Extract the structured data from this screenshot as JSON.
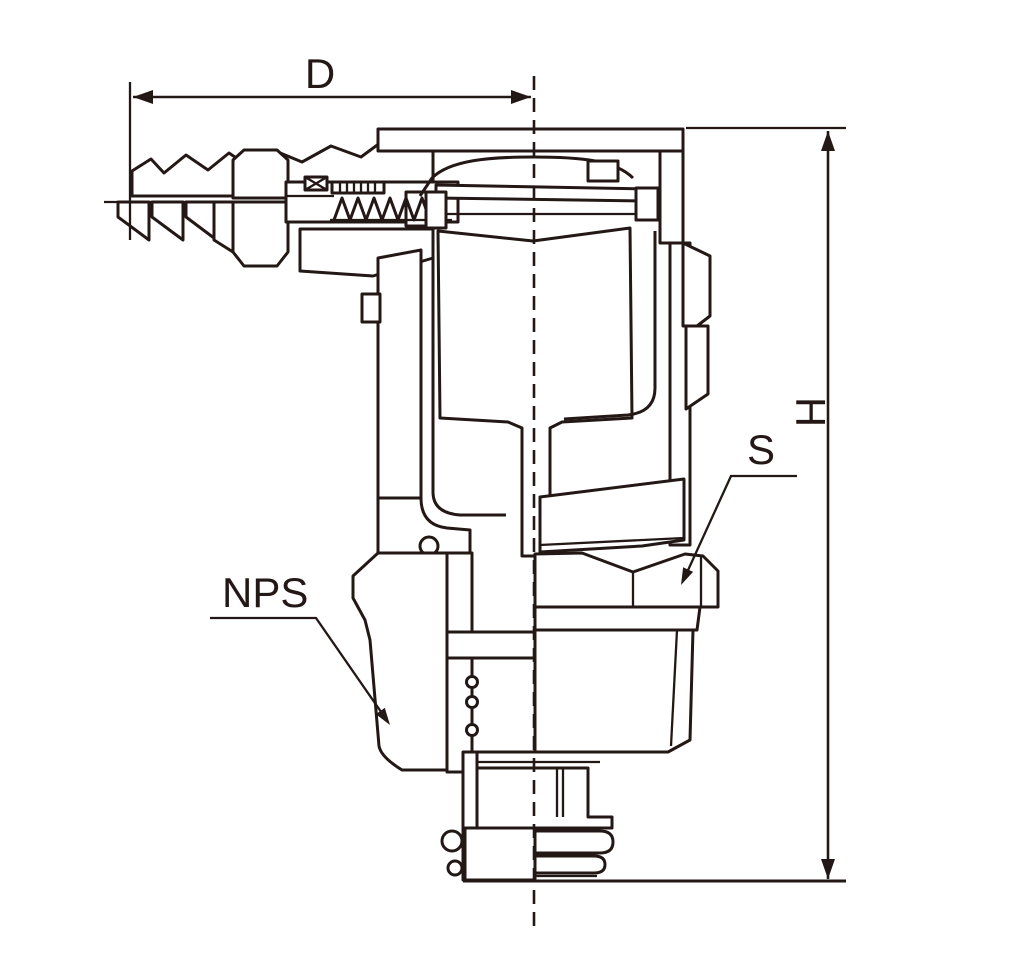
{
  "figure": {
    "type": "technical-cross-section-drawing",
    "background_color": "#ffffff",
    "line_color": "#231815",
    "labels": {
      "dim_diameter": "D",
      "dim_height": "H",
      "hex_across_flats": "S",
      "thread_callout": "NPS"
    }
  }
}
